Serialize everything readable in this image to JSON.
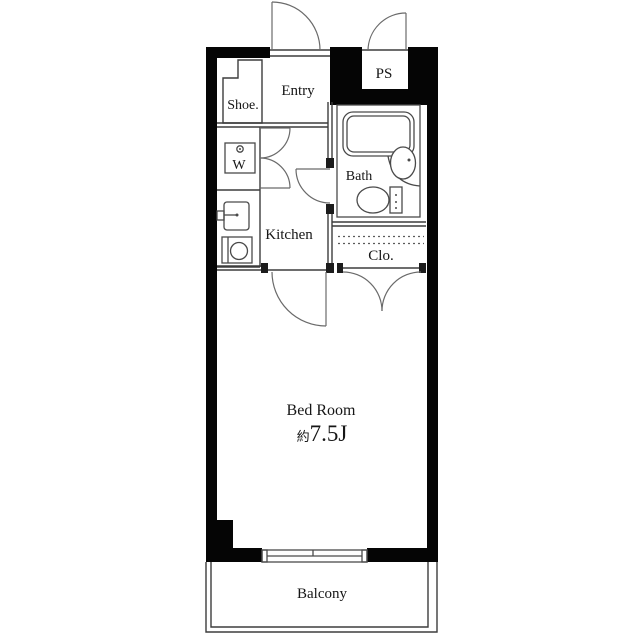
{
  "title": "apartment-floor-plan",
  "colors": {
    "wall": "#050505",
    "line": "#3d3d3d",
    "background": "#ffffff"
  },
  "rooms": {
    "entry": {
      "label": "Entry"
    },
    "shoe": {
      "label": "Shoe."
    },
    "ps": {
      "label": "PS"
    },
    "washer": {
      "label": "W"
    },
    "bath": {
      "label": "Bath"
    },
    "kitchen": {
      "label": "Kitchen"
    },
    "closet": {
      "label": "Clo."
    },
    "bedroom": {
      "label": "Bed Room",
      "size_prefix": "約",
      "size_value": "7.5J"
    },
    "balcony": {
      "label": "Balcony"
    }
  },
  "fixtures": [
    "bathtub-icon",
    "wash-basin-icon",
    "toilet-icon",
    "washing-machine-icon",
    "kitchen-sink-icon",
    "faucet-icon",
    "stove-icon",
    "sliding-window-icon",
    "door-swing-icon"
  ]
}
